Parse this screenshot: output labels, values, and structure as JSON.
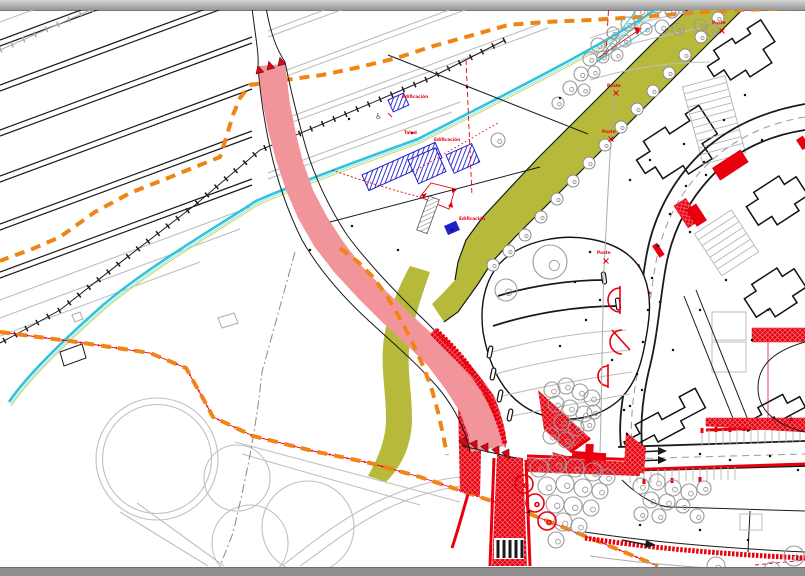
{
  "palette": {
    "proposed_road_pink": "#f2959a",
    "works_red": "#e8000f",
    "boundary_orange": "#f08415",
    "water_cyan": "#2fc4da",
    "landscape_olive": "#b7b93b",
    "existing_gray": "#bfbfbf",
    "building_blue": "#2121cc",
    "line_black": "#1a1a1a",
    "chrome_gray": "#8f8f8f"
  },
  "plan": {
    "labels": [
      {
        "text": "Edificación",
        "x": 402,
        "y": 98,
        "cls": "lbl"
      },
      {
        "text": "Talud",
        "x": 404,
        "y": 134,
        "cls": "lbl"
      },
      {
        "text": "Edificación",
        "x": 434,
        "y": 141,
        "cls": "lbl"
      },
      {
        "text": "Edificación",
        "x": 459,
        "y": 220,
        "cls": "lbl"
      },
      {
        "text": "Poste",
        "x": 712,
        "y": 24,
        "cls": "lbl"
      },
      {
        "text": "Poste",
        "x": 607,
        "y": 87,
        "cls": "lbl"
      },
      {
        "text": "Poste",
        "x": 602,
        "y": 133,
        "cls": "lbl"
      },
      {
        "text": "Poste",
        "x": 597,
        "y": 254,
        "cls": "lbl"
      },
      {
        "text": "2",
        "x": 789,
        "y": 421,
        "cls": "lblk"
      }
    ],
    "symbols": {
      "disabled_parking": {
        "glyph": "♿",
        "x": 375,
        "y": 119
      }
    },
    "poste_markers": [
      [
        722,
        31
      ],
      [
        616,
        93
      ],
      [
        611,
        139
      ],
      [
        606,
        261
      ]
    ],
    "trees": {
      "gray": [
        [
          641,
          11,
          7
        ],
        [
          657,
          7,
          6
        ],
        [
          672,
          11,
          7
        ],
        [
          687,
          7,
          6
        ],
        [
          628,
          24,
          7
        ],
        [
          613,
          33,
          6
        ],
        [
          646,
          29,
          6
        ],
        [
          662,
          27,
          7
        ],
        [
          678,
          29,
          6
        ],
        [
          598,
          45,
          7
        ],
        [
          611,
          44,
          6
        ],
        [
          625,
          41,
          6
        ],
        [
          590,
          59,
          7
        ],
        [
          603,
          57,
          6
        ],
        [
          617,
          55,
          6
        ],
        [
          581,
          74,
          7
        ],
        [
          594,
          72,
          6
        ],
        [
          570,
          88,
          7
        ],
        [
          584,
          90,
          6
        ],
        [
          558,
          103,
          6
        ],
        [
          700,
          25,
          6
        ],
        [
          712,
          30,
          6
        ],
        [
          498,
          140,
          7
        ],
        [
          550,
          262,
          17
        ],
        [
          506,
          290,
          11
        ],
        [
          552,
          390,
          8
        ],
        [
          566,
          386,
          8
        ],
        [
          580,
          392,
          8
        ],
        [
          592,
          398,
          8
        ],
        [
          556,
          404,
          8
        ],
        [
          570,
          408,
          8
        ],
        [
          584,
          414,
          8
        ],
        [
          594,
          412,
          7
        ],
        [
          562,
          422,
          8
        ],
        [
          576,
          428,
          8
        ],
        [
          588,
          424,
          7
        ],
        [
          551,
          436,
          8
        ],
        [
          566,
          440,
          8
        ],
        [
          539,
          468,
          9
        ],
        [
          557,
          464,
          9
        ],
        [
          575,
          468,
          9
        ],
        [
          593,
          472,
          9
        ],
        [
          607,
          477,
          8
        ],
        [
          547,
          486,
          9
        ],
        [
          565,
          484,
          9
        ],
        [
          583,
          488,
          9
        ],
        [
          600,
          491,
          8
        ],
        [
          555,
          504,
          9
        ],
        [
          573,
          506,
          9
        ],
        [
          591,
          508,
          8
        ],
        [
          563,
          522,
          9
        ],
        [
          579,
          526,
          8
        ],
        [
          556,
          540,
          8
        ],
        [
          641,
          486,
          8
        ],
        [
          657,
          482,
          8
        ],
        [
          673,
          488,
          8
        ],
        [
          689,
          492,
          8
        ],
        [
          704,
          488,
          7
        ],
        [
          651,
          500,
          8
        ],
        [
          667,
          502,
          8
        ],
        [
          683,
          506,
          7
        ],
        [
          641,
          514,
          7
        ],
        [
          659,
          516,
          7
        ],
        [
          697,
          516,
          7
        ],
        [
          716,
          566,
          9
        ],
        [
          794,
          556,
          10
        ],
        [
          772,
          570,
          8
        ]
      ],
      "band": [
        [
          718,
          18,
          6
        ],
        [
          701,
          37,
          6
        ],
        [
          685,
          55,
          6
        ],
        [
          669,
          73,
          6
        ],
        [
          653,
          91,
          6
        ],
        [
          637,
          109,
          6
        ],
        [
          621,
          127,
          6
        ],
        [
          605,
          145,
          6
        ],
        [
          589,
          163,
          6
        ],
        [
          573,
          181,
          6
        ],
        [
          557,
          199,
          6
        ],
        [
          541,
          217,
          6
        ],
        [
          525,
          235,
          6
        ],
        [
          509,
          251,
          6
        ],
        [
          493,
          265,
          6
        ]
      ],
      "red": [
        [
          524,
          484,
          9
        ],
        [
          535,
          503,
          9
        ],
        [
          547,
          521,
          9
        ]
      ]
    },
    "dots": [
      [
        349,
        119
      ],
      [
        412,
        133
      ],
      [
        467,
        87
      ],
      [
        452,
        230
      ],
      [
        398,
        250
      ],
      [
        529,
        512
      ],
      [
        560,
        346
      ],
      [
        586,
        320
      ],
      [
        600,
        300
      ],
      [
        612,
        360
      ],
      [
        624,
        410
      ],
      [
        642,
        390
      ],
      [
        660,
        302
      ],
      [
        673,
        350
      ],
      [
        690,
        232
      ],
      [
        706,
        175
      ],
      [
        724,
        120
      ],
      [
        745,
        95
      ],
      [
        762,
        140
      ],
      [
        684,
        144
      ],
      [
        700,
        310
      ],
      [
        726,
        280
      ],
      [
        752,
        340
      ],
      [
        768,
        310
      ],
      [
        700,
        454
      ],
      [
        730,
        460
      ],
      [
        770,
        456
      ],
      [
        798,
        470
      ],
      [
        640,
        525
      ],
      [
        700,
        530
      ],
      [
        748,
        540
      ],
      [
        630,
        180
      ],
      [
        650,
        160
      ],
      [
        590,
        252
      ],
      [
        575,
        282
      ],
      [
        560,
        98
      ],
      [
        352,
        226
      ],
      [
        310,
        250
      ],
      [
        704,
        162
      ],
      [
        686,
        186
      ],
      [
        670,
        214
      ],
      [
        658,
        246
      ],
      [
        652,
        278
      ],
      [
        648,
        310
      ],
      [
        643,
        342
      ],
      [
        637,
        374
      ],
      [
        630,
        406
      ],
      [
        627,
        434
      ]
    ]
  }
}
